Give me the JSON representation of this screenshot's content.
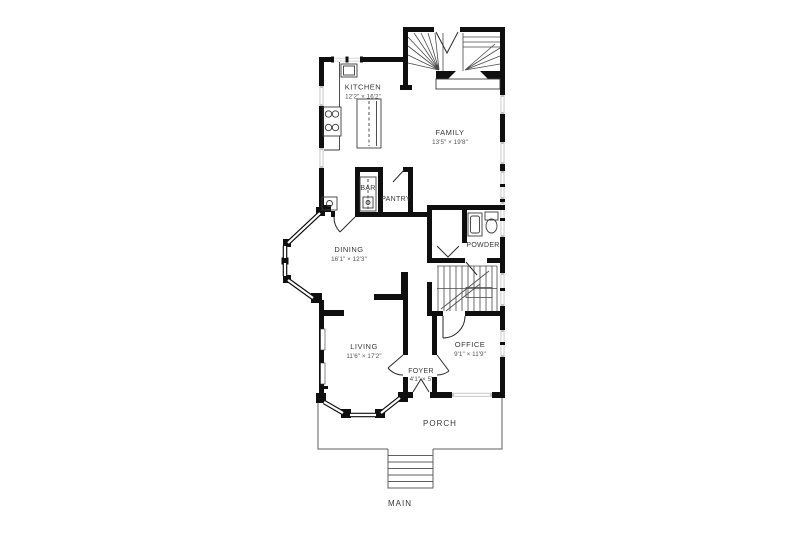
{
  "plan": {
    "type": "floor-plan",
    "colors": {
      "wall": "#0f0f0f",
      "window": "#c4c4c4",
      "line": "#3c3c3c",
      "label": "#383838",
      "dim": "#505050",
      "background": "#ffffff"
    }
  },
  "rooms": [
    {
      "id": "kitchen",
      "name": "KITCHEN",
      "dims": "12'2\" × 16'2\""
    },
    {
      "id": "family",
      "name": "FAMILY",
      "dims": "13'5\" × 19'8\""
    },
    {
      "id": "bar",
      "name": "BAR",
      "dims": ""
    },
    {
      "id": "pantry",
      "name": "PANTRY",
      "dims": ""
    },
    {
      "id": "dining",
      "name": "DINING",
      "dims": "16'1\" × 12'3\""
    },
    {
      "id": "powder",
      "name": "POWDER",
      "dims": ""
    },
    {
      "id": "living",
      "name": "LIVING",
      "dims": "11'6\" × 17'2\""
    },
    {
      "id": "office",
      "name": "OFFICE",
      "dims": "9'1\" × 11'9\""
    },
    {
      "id": "foyer",
      "name": "FOYER",
      "dims": "4'1\" × 5'"
    },
    {
      "id": "porch",
      "name": "PORCH",
      "dims": ""
    },
    {
      "id": "main",
      "name": "MAIN",
      "dims": ""
    }
  ]
}
